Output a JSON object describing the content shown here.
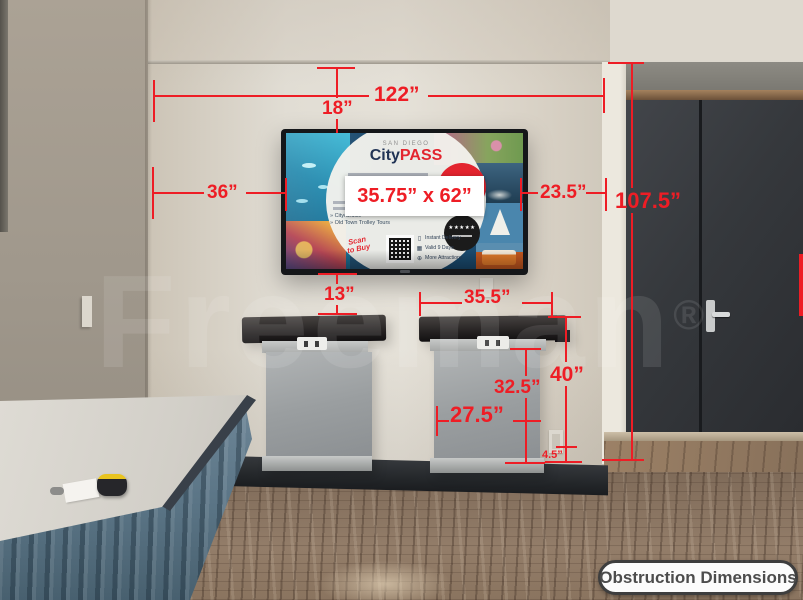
{
  "colors": {
    "annotation_red": "#ee1d25",
    "brand_navy": "#1c2f52",
    "brand_red": "#e3242e"
  },
  "watermark": {
    "text": "Freeman",
    "mark": "®"
  },
  "badge": {
    "label": "Obstruction Dimensions"
  },
  "dims": {
    "wall_width": "122”",
    "gap_trim_to_tv": "18”",
    "gap_left": "36”",
    "tv_size": "35.75” x 62”",
    "gap_right": "23.5”",
    "right_height": "107.5”",
    "tv_to_counter": "13”",
    "counter_width": "35.5”",
    "counter_height": "40”",
    "counter_body_height": "32.5”",
    "counter_body_width": "27.5”",
    "base_height": "4.5”"
  },
  "tv": {
    "location": "SAN DIEGO",
    "brand_city": "City",
    "brand_pass": "PASS",
    "bullet_1": "» City/Cruise",
    "bullet_2": "» Old Town Trolley Tours",
    "scan_line1": "Scan",
    "scan_line2": "to Buy",
    "stars": "★★★★★",
    "features": [
      {
        "icon": "▯",
        "label": "Instant Delivery"
      },
      {
        "icon": "▦",
        "label": "Valid 9 Days"
      },
      {
        "icon": "⊕",
        "label": "More Attractions"
      }
    ]
  }
}
